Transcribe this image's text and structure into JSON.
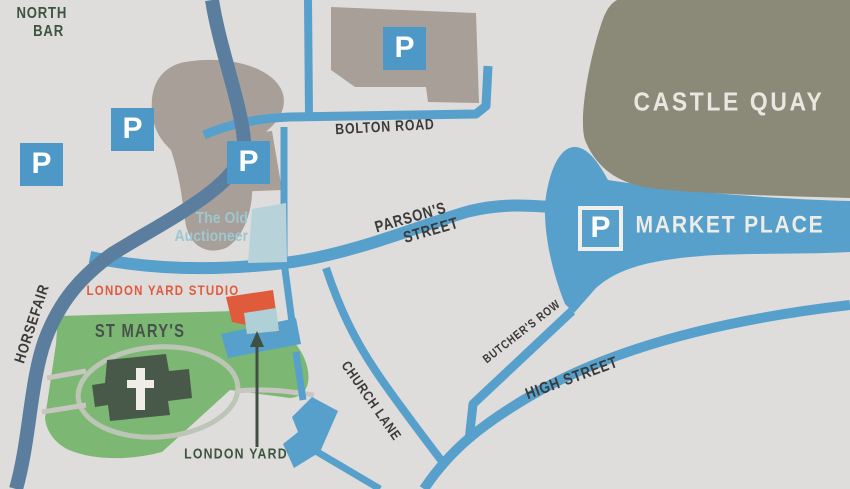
{
  "areas": {
    "castle_quay": "CASTLE QUAY",
    "market_place": "MARKET PLACE",
    "st_marys": "ST MARY'S"
  },
  "streets": {
    "north_bar": {
      "line1": "NORTH",
      "line2": "BAR"
    },
    "bolton_road": "BOLTON ROAD",
    "parsons_street": {
      "line1": "PARSON'S",
      "line2": "STREET"
    },
    "horsefair": "HORSEFAIR",
    "church_lane": "CHURCH LANE",
    "butchers_row": "BUTCHER'S ROW",
    "high_street": "HIGH STREET"
  },
  "places": {
    "old_auctioneer": {
      "line1": "The Old",
      "line2": "Auctioneer"
    },
    "london_yard_studio": "LONDON YARD STUDIO",
    "london_yard": "LONDON YARD"
  },
  "parking_symbol": "P",
  "colors": {
    "background": "#dedddb",
    "road_primary_blue": "#57a0cc",
    "road_dark_blue": "#5b7e9f",
    "parking_icon_blue": "#4d98c6",
    "castle_quay_olive": "#8b8977",
    "building_taupe": "#a79f98",
    "churchyard_green": "#7cb873",
    "church_dark_green": "#48594a",
    "highlight_orange": "#e05a3c",
    "auctioneer_pale_blue": "#b7d3d9",
    "street_label_gray": "#3a3a38",
    "landmark_label_green": "#3d5440"
  }
}
